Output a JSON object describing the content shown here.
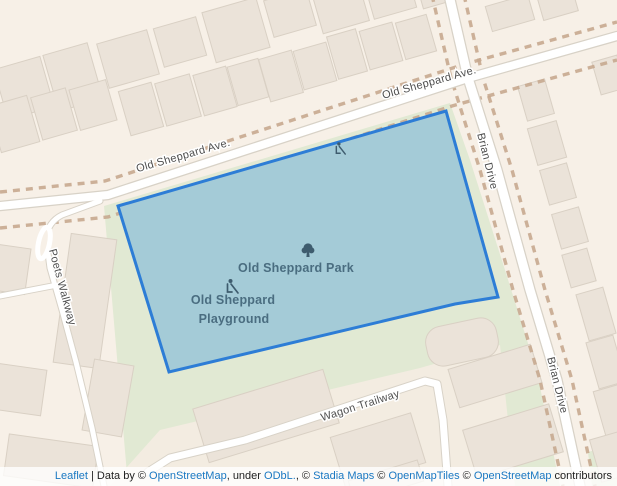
{
  "colors": {
    "park_fill": "#a4cbd7",
    "park_stroke": "#2d7dd6",
    "poi_label": "#4a6d80",
    "poi_icon": "#3e5c6e",
    "link": "#1a78c2"
  },
  "map": {
    "street_labels": {
      "old_sheppard_ave_left": "Old Sheppard Ave.",
      "old_sheppard_ave_right": "Old Sheppard Ave.",
      "brian_drive_top": "Brian Drive",
      "brian_drive_bottom": "Brian Drive",
      "poets_walkway": "Poets Walkway",
      "wagon_trailway": "Wagon Trailway"
    },
    "poi_labels": {
      "park": "Old Sheppard Park",
      "playground_line1": "Old Sheppard",
      "playground_line2": "Playground"
    }
  },
  "attribution": {
    "parts": [
      {
        "text": "Leaflet",
        "link": true
      },
      {
        "text": " | Data by © ",
        "link": false
      },
      {
        "text": "OpenStreetMap",
        "link": true
      },
      {
        "text": ", under ",
        "link": false
      },
      {
        "text": "ODbL.",
        "link": true
      },
      {
        "text": ", © ",
        "link": false
      },
      {
        "text": "Stadia Maps",
        "link": true
      },
      {
        "text": " © ",
        "link": false
      },
      {
        "text": "OpenMapTiles",
        "link": true
      },
      {
        "text": " © ",
        "link": false
      },
      {
        "text": "OpenStreetMap",
        "link": true
      },
      {
        "text": " contributors",
        "link": false
      }
    ]
  }
}
